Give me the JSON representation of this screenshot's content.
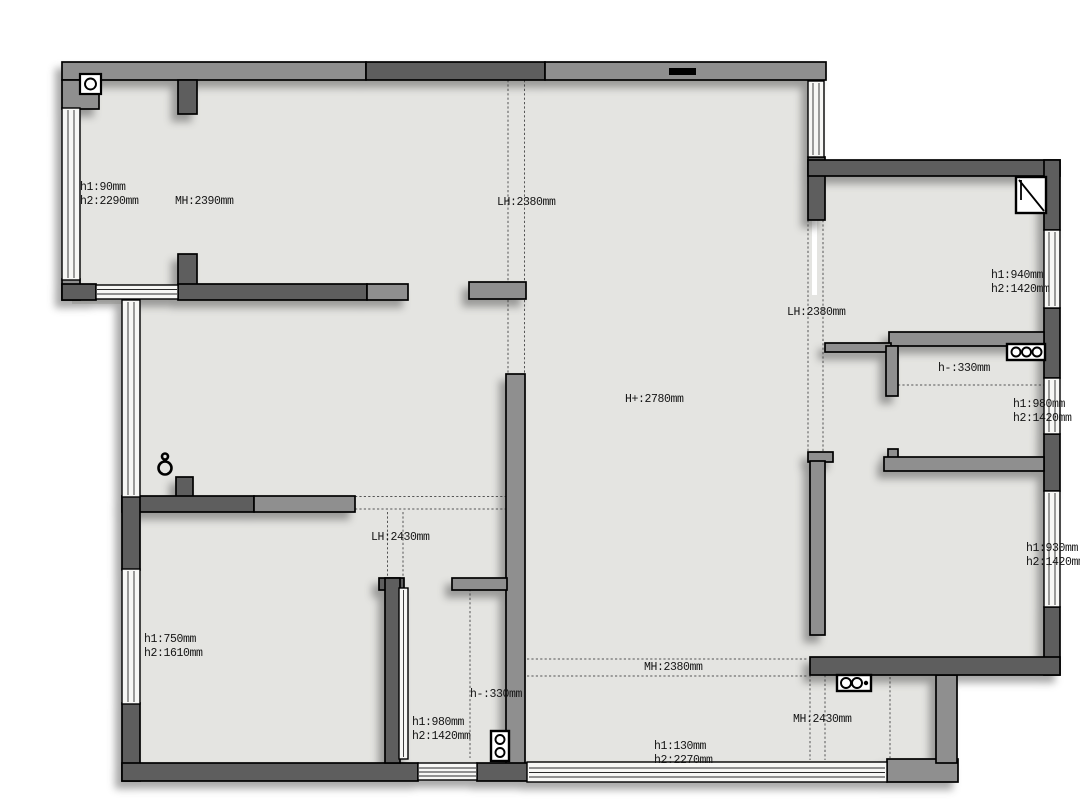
{
  "document": {
    "kind": "architectural floor plan with ceiling/sill height annotations"
  },
  "colors": {
    "background": "#ffffff",
    "floor": "#e4e4e1",
    "wall_dark": "#5e5e5e",
    "wall_medium": "#8f8f8f",
    "outline": "#000000",
    "window_fill": "#f7f7f5",
    "guide": "#555555"
  },
  "symbols": {
    "corner_column": "column-with-pipe-circle",
    "ceiling_light": "pendant-light",
    "kitchen_corner_unit": "corner-unit-diagonal",
    "cooktop_three_burner": "3-burner-cooktop",
    "cooktop_two_burner": "2-burner-cooktop",
    "meter_unit": "meter-with-two-dials"
  },
  "annotations": {
    "top_left_room": {
      "h1": "h1:90mm",
      "h2": "h2:2290mm",
      "mh": "MH:2390mm"
    },
    "kitchen_pass_opening": {
      "lh": "LH:2380mm"
    },
    "right_wing_opening": {
      "lh": "LH:2380mm"
    },
    "kitchen": {
      "window_h1": "h1:940mm",
      "window_h2": "h2:1420mm",
      "counter_h": "h-:330mm",
      "window2_h1": "h1:980mm",
      "window2_h2": "h2:1420mm"
    },
    "living_area": {
      "ceiling_h": "H+:2780mm"
    },
    "hallway_opening": {
      "lh": "LH:2430mm"
    },
    "bottom_left_room": {
      "h1": "h1:750mm",
      "h2": "h2:1610mm"
    },
    "bathroom": {
      "counter_h": "h-:330mm",
      "window_h1": "h1:980mm",
      "window_h2": "h2:1420mm"
    },
    "balcony_door": {
      "mh": "MH:2380mm",
      "h1": "h1:130mm",
      "h2": "h2:2270mm"
    },
    "bottom_right_room": {
      "window_h1": "h1:930mm",
      "window_h2": "h2:1420mm"
    },
    "balcony": {
      "mh": "MH:2430mm"
    }
  }
}
